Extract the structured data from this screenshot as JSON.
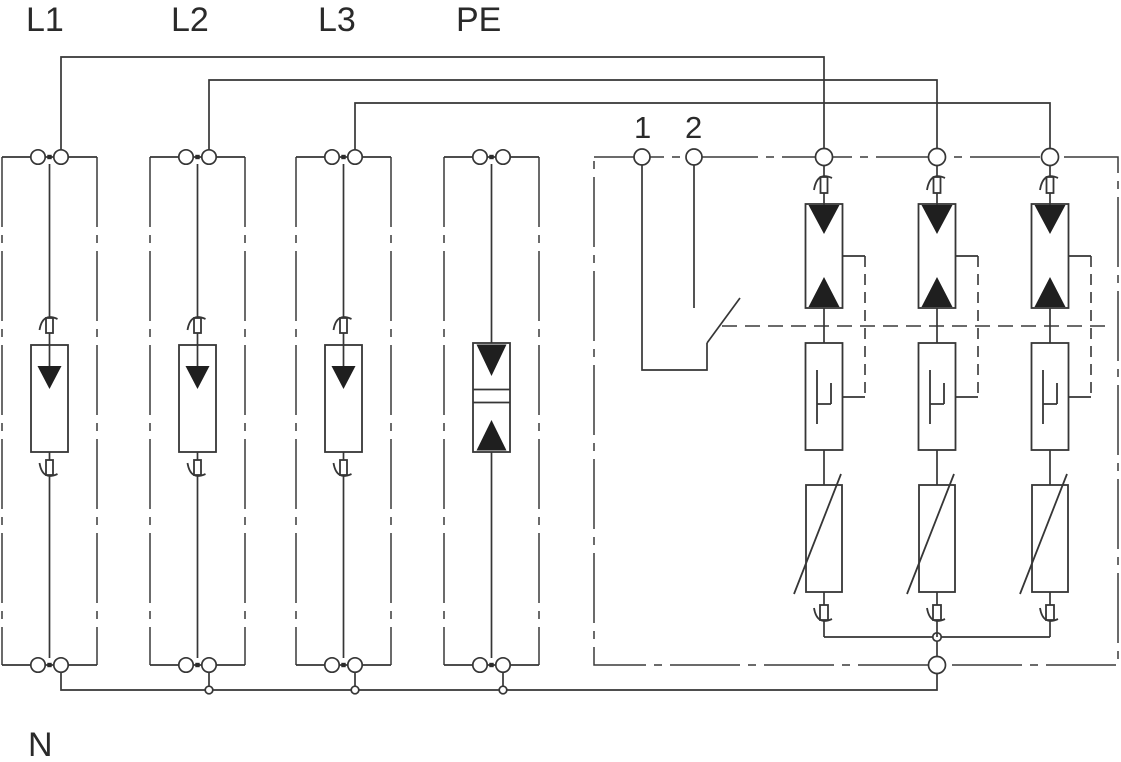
{
  "diagram": {
    "type": "three-phase surge protective device (SPD) wiring schematic",
    "background_color": "#ffffff",
    "line_color": "#363636",
    "conductor_labels": {
      "l1": "L1",
      "l2": "L2",
      "l3": "L3",
      "pe": "PE",
      "n": "N"
    },
    "remote_contact_labels": {
      "terminal_1": "1",
      "terminal_2": "2"
    },
    "symbols": {
      "plug_module": "arrester-cartridge-with-thermal-disconnectors",
      "pe_module": "isolating-spark-gap",
      "spd_branch": "triggered-spark-gap, trigger-unit and varistor in series",
      "remote_signalling": "floating-changeover-switch-contact",
      "terminal": "circle-terminal-on-enclosure-boundary",
      "junction": "small-circle-node"
    }
  }
}
